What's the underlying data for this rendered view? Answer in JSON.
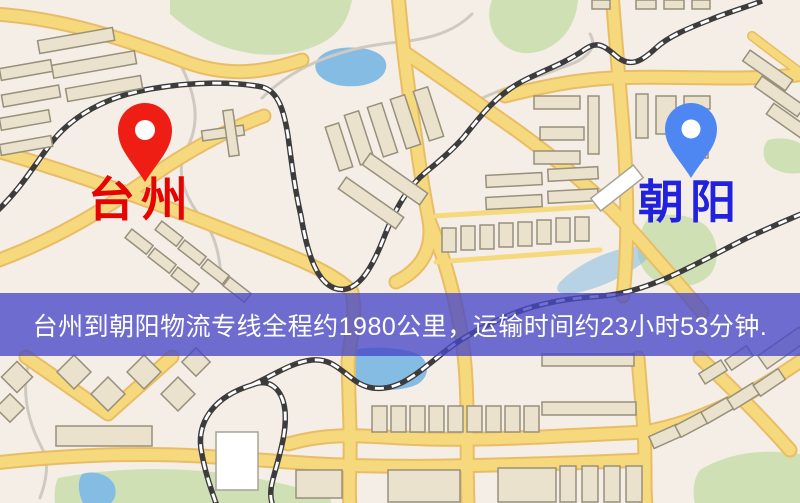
{
  "map": {
    "origin": {
      "label": "台州"
    },
    "destination": {
      "label": "朝阳"
    },
    "banner": {
      "text": "台州到朝阳物流专线全程约1980公里，运输时间约23小时53分钟."
    },
    "colors": {
      "map_background": "#f4eee6",
      "green_area": "#cfe0b5",
      "water": "#85bce4",
      "path_gray": "#cfc9c0",
      "road_yellow": "#f6d87d",
      "road_casing": "#e9bd66",
      "railway_dark": "#3c3c3c",
      "railway_dash": "#ffffff",
      "building_fill": "#eae2cc",
      "building_stroke": "#97907c",
      "building_white": "#ffffff",
      "origin_pin": "#ee1e14",
      "origin_text": "#e60400",
      "destination_pin": "#4e87f2",
      "destination_text": "#2222dd",
      "banner_bg": "rgba(72,72,198,0.78)",
      "banner_text_color": "#ffffff"
    }
  }
}
